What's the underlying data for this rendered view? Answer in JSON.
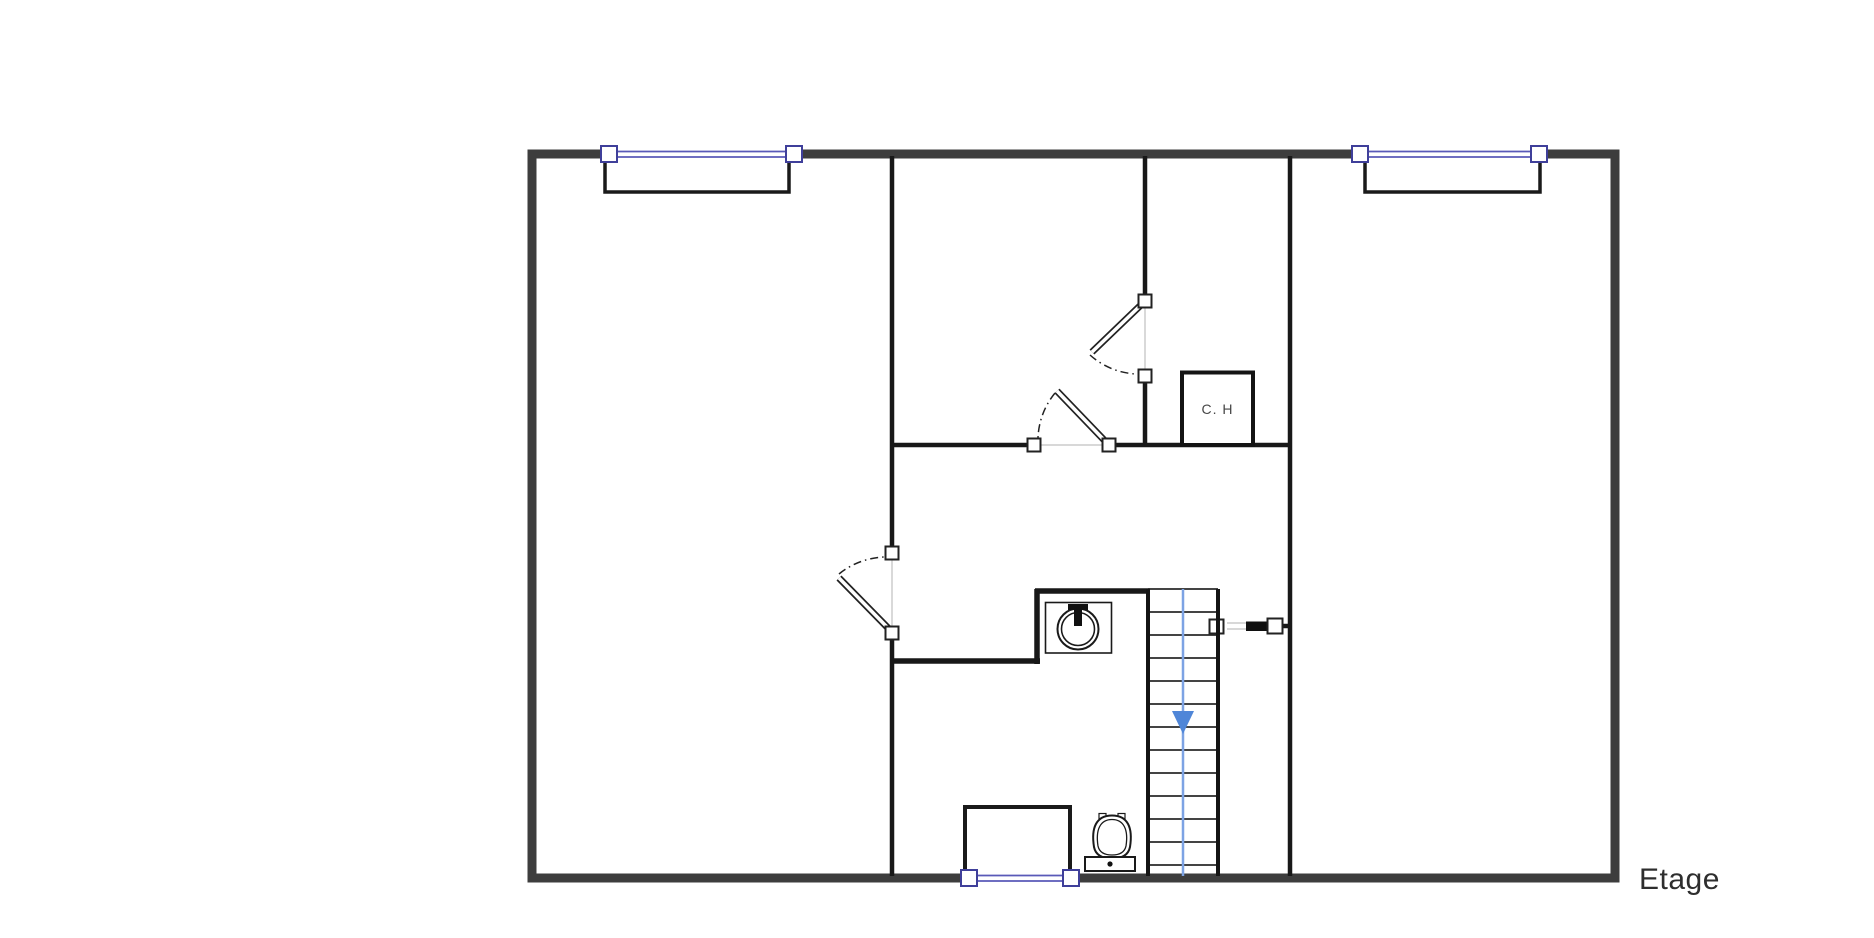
{
  "plan": {
    "floor_label": "Etage",
    "room_labels": {
      "water_heater": "C. H"
    },
    "colors": {
      "background": "#ffffff",
      "outer_wall": "#3d3d3d",
      "interior_wall": "#181818",
      "window_glass": "#5959b8",
      "window_frame": "#3f3f9a",
      "threshold": "#cccccc",
      "stair_guide": "#7da3e4",
      "stair_arrow": "#4f86d8",
      "label_text": "#2e2e2e"
    },
    "fixtures": {
      "windows": [
        "window-top-left",
        "window-top-right",
        "window-bottom"
      ],
      "doors": [
        "door-left-room",
        "door-upper-room",
        "door-corridor",
        "door-right-room-closed"
      ],
      "stairs": "stairs-going-down",
      "sanitary": [
        "washbasin",
        "toilet"
      ],
      "utility": "water-heater-closet"
    }
  }
}
